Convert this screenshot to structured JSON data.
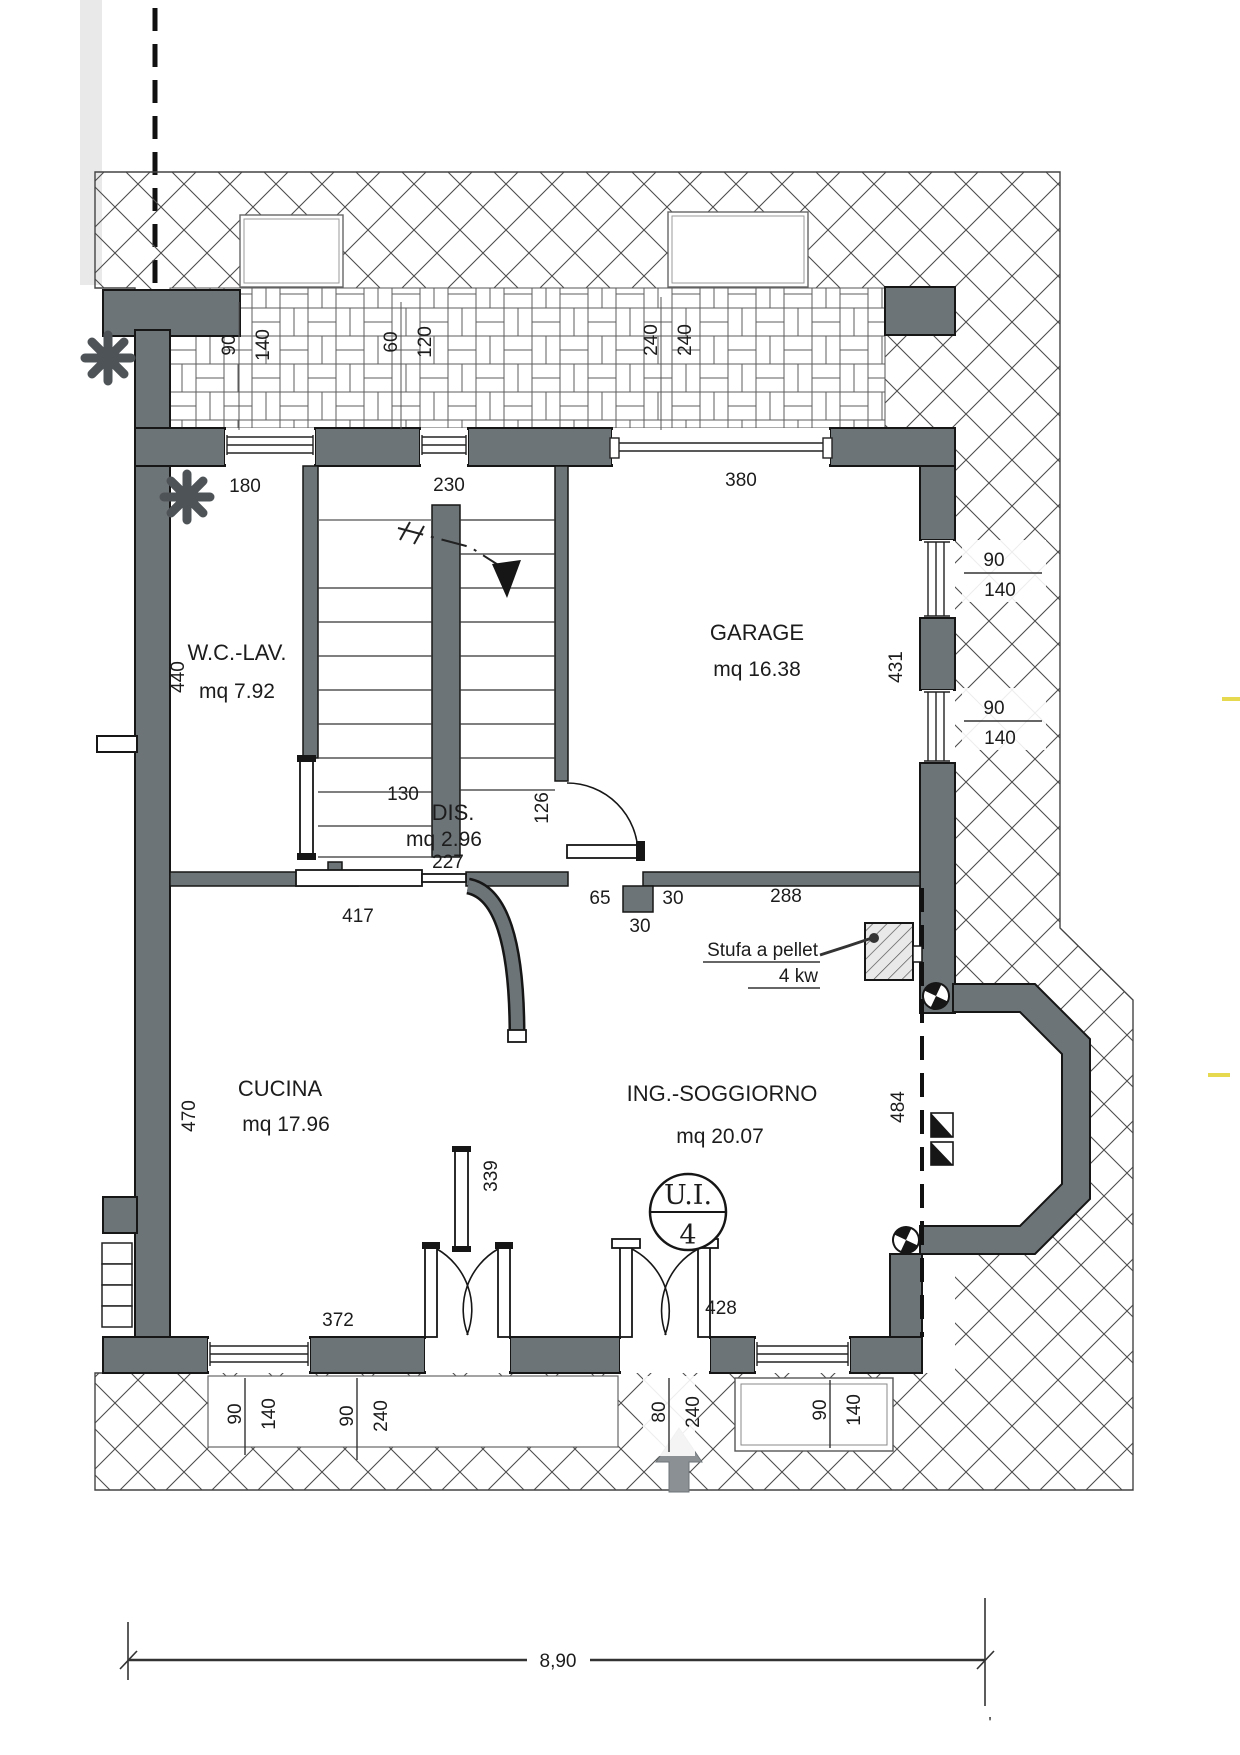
{
  "rooms": {
    "wc": {
      "name": "W.C.-LAV.",
      "area": "mq 7.92"
    },
    "dis": {
      "name": "DIS.",
      "area": "mq 2.96"
    },
    "garage": {
      "name": "GARAGE",
      "area": "mq 16.38"
    },
    "cucina": {
      "name": "CUCINA",
      "area": "mq 17.96"
    },
    "soggiorno": {
      "name": "ING.-SOGGIORNO",
      "area": "mq 20.07"
    }
  },
  "unit_badge": {
    "label": "U.I.",
    "number": "4"
  },
  "stove": {
    "line1": "Stufa a pellet",
    "line2": "4 kw"
  },
  "dims": {
    "d180": "180",
    "d230": "230",
    "d380": "380",
    "d440": "440",
    "d431": "431",
    "d130": "130",
    "d126": "126",
    "d227": "227",
    "d417": "417",
    "d65": "65",
    "d30a": "30",
    "d30b": "30",
    "d288": "288",
    "d470": "470",
    "d339": "339",
    "d484": "484",
    "d372": "372",
    "d428": "428"
  },
  "openings": {
    "top_window_left": {
      "w": "90",
      "h": "140"
    },
    "top_window_mid": {
      "w": "60",
      "h": "120"
    },
    "garage_door": {
      "w": "240",
      "h": "240"
    },
    "garage_window_upper": {
      "w": "90",
      "h": "140"
    },
    "garage_window_lower": {
      "w": "90",
      "h": "140"
    },
    "kitchen_window": {
      "w": "90",
      "h": "140"
    },
    "kitchen_french_door": {
      "w": "90",
      "h": "240"
    },
    "entrance_door": {
      "w": "80",
      "h": "240"
    },
    "living_window": {
      "w": "90",
      "h": "140"
    }
  },
  "scale_bar": {
    "total": "8,90",
    "end_mark": "'"
  }
}
